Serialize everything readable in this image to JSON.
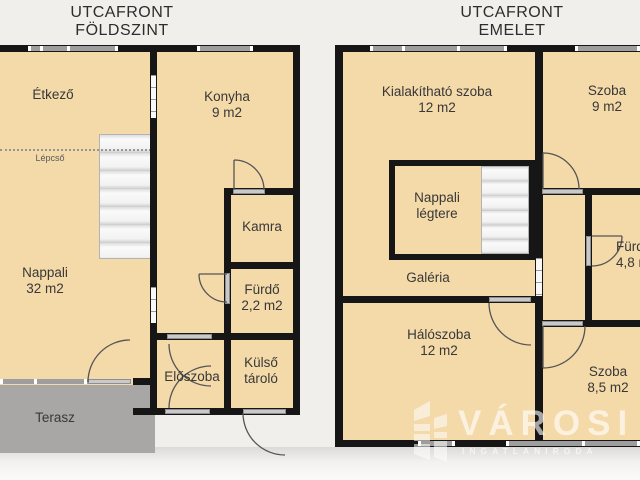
{
  "colors": {
    "room_fill": "#f4d9a9",
    "wall": "#161616",
    "terrace_fill": "#a8a7a5",
    "background": "#f1efec",
    "window_gray": "#9e9e9e",
    "watermark_white": "rgba(255,255,255,0.62)"
  },
  "floorplans": [
    {
      "id": "ground-floor",
      "title_line1": "UTCAFRONT",
      "title_line2": "FÖLDSZINT",
      "rooms": [
        {
          "name": "Étkező"
        },
        {
          "name": "Konyha",
          "area": "9 m2"
        },
        {
          "name": "Lépcső"
        },
        {
          "name": "Nappali",
          "area": "32 m2"
        },
        {
          "name": "Kamra"
        },
        {
          "name": "Fürdő",
          "area": "2,2 m2"
        },
        {
          "name": "Előszoba"
        },
        {
          "name": "Külső tároló"
        },
        {
          "name": "Terasz"
        }
      ]
    },
    {
      "id": "upper-floor",
      "title_line1": "UTCAFRONT",
      "title_line2": "EMELET",
      "rooms": [
        {
          "name": "Kialakítható szoba",
          "area": "12 m2"
        },
        {
          "name": "Szoba",
          "area": "9 m2"
        },
        {
          "name": "Nappali légtere"
        },
        {
          "name": "Galéria"
        },
        {
          "name": "Hálószoba",
          "area": "12 m2"
        },
        {
          "name": "Szoba",
          "area": "8,5 m2"
        },
        {
          "name": "Fürdő",
          "area": "4,8 m2"
        }
      ]
    }
  ],
  "watermark": {
    "brand": "VÁROSI",
    "tagline": "INGATLANIRODA",
    "icon": "building-icon"
  }
}
